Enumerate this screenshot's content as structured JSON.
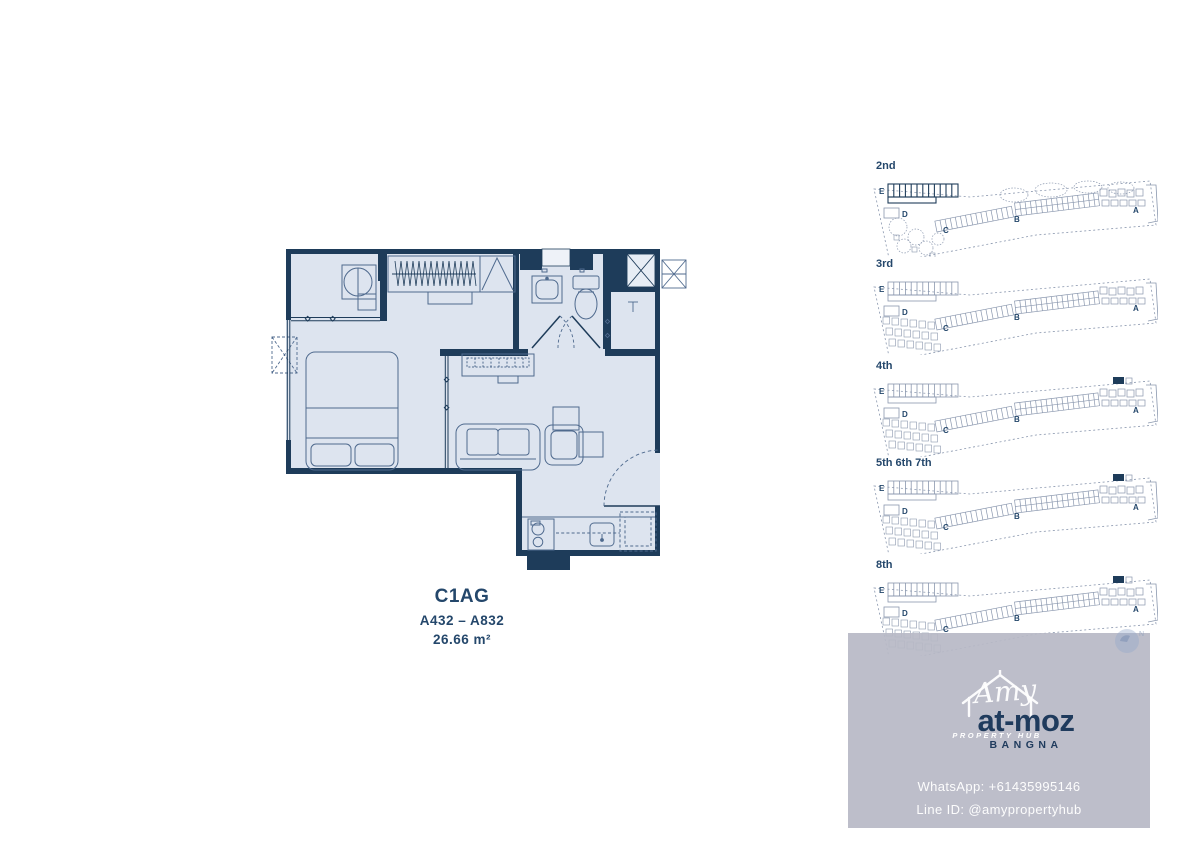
{
  "unit": {
    "title": "C1AG",
    "range": "A432 – A832",
    "area": "26.66 m²"
  },
  "key_plans": {
    "section_labels": [
      "E",
      "D",
      "C",
      "B",
      "A"
    ],
    "floors": [
      {
        "label": "2nd",
        "highlight": false,
        "garden": true
      },
      {
        "label": "3rd",
        "highlight": false,
        "garden": false
      },
      {
        "label": "4th",
        "highlight": true,
        "garden": false
      },
      {
        "label": "5th 6th 7th",
        "highlight": true,
        "garden": false
      },
      {
        "label": "8th",
        "highlight": true,
        "garden": false
      }
    ]
  },
  "branding": {
    "watermark_script": "Amy",
    "watermark_sub": "PROPERTY HUB",
    "logo_text": "at-moz",
    "location": "BANGNA",
    "contact_whatsapp": "WhatsApp: +61435995146",
    "contact_line": "Line ID: @amypropertyhub",
    "compass_letter": "N"
  },
  "colors": {
    "wall": "#1e3c5a",
    "floor_fill": "#dde4ef",
    "balcony_fill": "#e7edf5",
    "shaft_fill": "#eef2f8",
    "furniture_line": "#4f6a8e",
    "keyplan_line": "#8a97ae",
    "navy_text": "#24476b",
    "overlay": "rgba(183,185,197,0.92)",
    "compass_fill": "#93a7cb"
  }
}
